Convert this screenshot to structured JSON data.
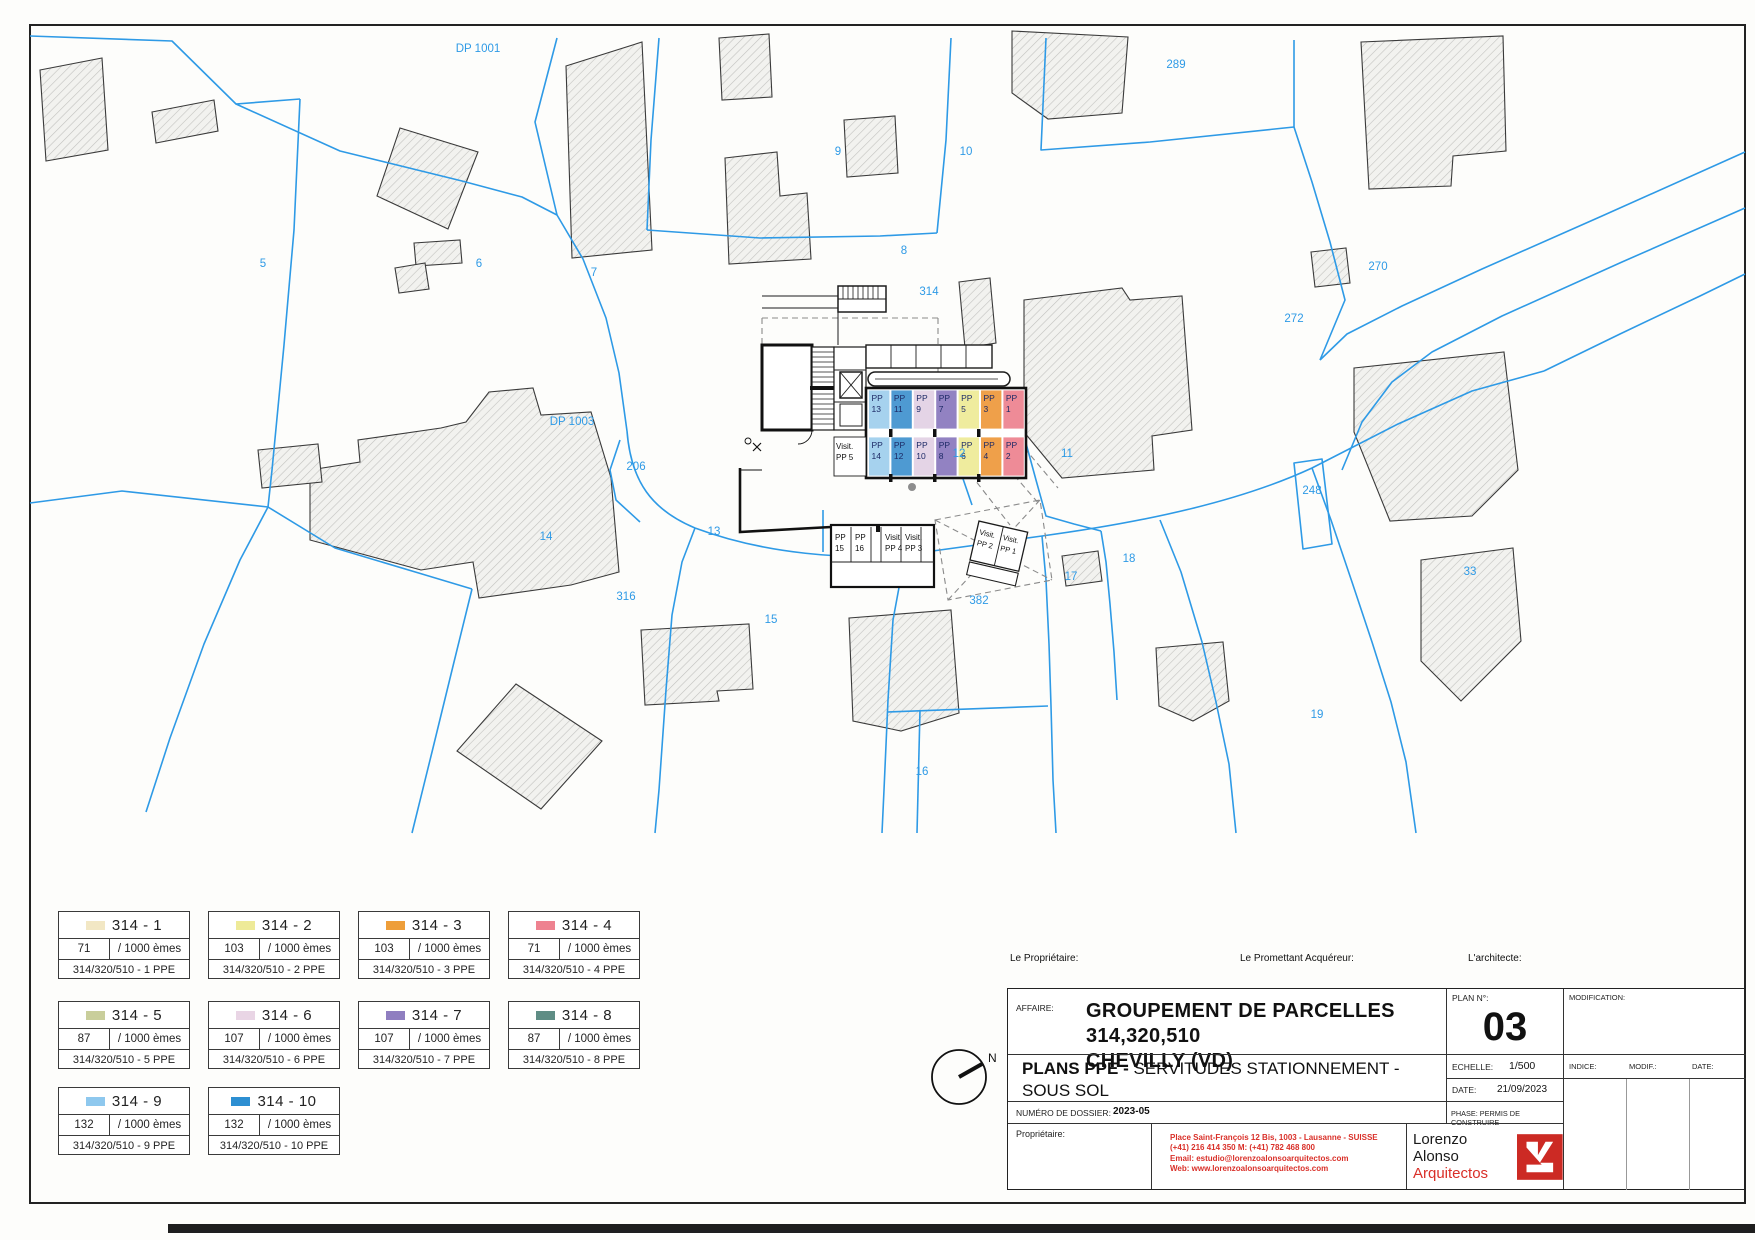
{
  "map": {
    "parcels": [
      {
        "label": "DP 1001",
        "x": 478,
        "y": 52
      },
      {
        "label": "289",
        "x": 1176,
        "y": 68
      },
      {
        "label": "5",
        "x": 263,
        "y": 267
      },
      {
        "label": "6",
        "x": 479,
        "y": 267
      },
      {
        "label": "7",
        "x": 594,
        "y": 276
      },
      {
        "label": "9",
        "x": 838,
        "y": 155
      },
      {
        "label": "10",
        "x": 966,
        "y": 155
      },
      {
        "label": "8",
        "x": 904,
        "y": 254
      },
      {
        "label": "314",
        "x": 929,
        "y": 295
      },
      {
        "label": "270",
        "x": 1378,
        "y": 270
      },
      {
        "label": "272",
        "x": 1294,
        "y": 322
      },
      {
        "label": "DP 1003",
        "x": 572,
        "y": 425
      },
      {
        "label": "206",
        "x": 636,
        "y": 470
      },
      {
        "label": "12",
        "x": 959,
        "y": 457
      },
      {
        "label": "11",
        "x": 1067,
        "y": 457
      },
      {
        "label": "248",
        "x": 1312,
        "y": 494
      },
      {
        "label": "14",
        "x": 546,
        "y": 540
      },
      {
        "label": "13",
        "x": 714,
        "y": 535
      },
      {
        "label": "316",
        "x": 626,
        "y": 600
      },
      {
        "label": "15",
        "x": 771,
        "y": 623
      },
      {
        "label": "382",
        "x": 979,
        "y": 604
      },
      {
        "label": "17",
        "x": 1071,
        "y": 580
      },
      {
        "label": "18",
        "x": 1129,
        "y": 562
      },
      {
        "label": "33",
        "x": 1470,
        "y": 575
      },
      {
        "label": "16",
        "x": 922,
        "y": 775
      },
      {
        "label": "19",
        "x": 1317,
        "y": 718
      }
    ],
    "garage": {
      "visit_left": {
        "l1": "Visit.",
        "l2": "PP 5"
      },
      "rows": [
        {
          "y": 390,
          "stalls": [
            {
              "l1": "PP",
              "l2": "13",
              "color": "#a6d2ee"
            },
            {
              "l1": "PP",
              "l2": "11",
              "color": "#4e9ad2"
            },
            {
              "l1": "PP",
              "l2": "9",
              "color": "#e4d4e6"
            },
            {
              "l1": "PP",
              "l2": "7",
              "color": "#9282c2"
            },
            {
              "l1": "PP",
              "l2": "5",
              "color": "#efec9e"
            },
            {
              "l1": "PP",
              "l2": "3",
              "color": "#efa04a"
            },
            {
              "l1": "PP",
              "l2": "1",
              "color": "#ee8b97"
            }
          ]
        },
        {
          "y": 437,
          "stalls": [
            {
              "l1": "PP",
              "l2": "14",
              "color": "#a6d2ee"
            },
            {
              "l1": "PP",
              "l2": "12",
              "color": "#4e9ad2"
            },
            {
              "l1": "PP",
              "l2": "10",
              "color": "#e4d4e6"
            },
            {
              "l1": "PP",
              "l2": "8",
              "color": "#9282c2"
            },
            {
              "l1": "PP",
              "l2": "6",
              "color": "#efec9e"
            },
            {
              "l1": "PP",
              "l2": "4",
              "color": "#efa04a"
            },
            {
              "l1": "PP",
              "l2": "2",
              "color": "#ee8b97"
            }
          ]
        }
      ],
      "lower_stalls": [
        {
          "l1": "PP",
          "l2": "15"
        },
        {
          "l1": "PP",
          "l2": "16"
        },
        {
          "l1": "Visit.",
          "l2": "PP 4"
        },
        {
          "l1": "Visit.",
          "l2": "PP 3"
        }
      ],
      "angled_stalls": [
        {
          "l1": "Visit.",
          "l2": "PP 2"
        },
        {
          "l1": "Visit.",
          "l2": "PP 1"
        }
      ]
    }
  },
  "legend": {
    "entries": [
      {
        "name": "314 - 1",
        "share": "71",
        "denom": "/ 1000 èmes",
        "ppe": "314/320/510 - 1 PPE",
        "color": "#f2e7c4"
      },
      {
        "name": "314 - 2",
        "share": "103",
        "denom": "/ 1000 èmes",
        "ppe": "314/320/510 - 2 PPE",
        "color": "#eeea98"
      },
      {
        "name": "314 - 3",
        "share": "103",
        "denom": "/ 1000 èmes",
        "ppe": "314/320/510 - 3 PPE",
        "color": "#ee9e3a"
      },
      {
        "name": "314 - 4",
        "share": "71",
        "denom": "/ 1000 èmes",
        "ppe": "314/320/510 - 4 PPE",
        "color": "#ee8290"
      },
      {
        "name": "314 - 5",
        "share": "87",
        "denom": "/ 1000 èmes",
        "ppe": "314/320/510 - 5 PPE",
        "color": "#c9ce9b"
      },
      {
        "name": "314 - 6",
        "share": "107",
        "denom": "/ 1000 èmes",
        "ppe": "314/320/510 - 6 PPE",
        "color": "#e9d5e5"
      },
      {
        "name": "314 - 7",
        "share": "107",
        "denom": "/ 1000 èmes",
        "ppe": "314/320/510 - 7 PPE",
        "color": "#8f7ec0"
      },
      {
        "name": "314 - 8",
        "share": "87",
        "denom": "/ 1000 èmes",
        "ppe": "314/320/510 - 8 PPE",
        "color": "#5f8d85"
      },
      {
        "name": "314 - 9",
        "share": "132",
        "denom": "/ 1000 èmes",
        "ppe": "314/320/510 - 9 PPE",
        "color": "#8ec8ee"
      },
      {
        "name": "314 - 10",
        "share": "132",
        "denom": "/ 1000 èmes",
        "ppe": "314/320/510 - 10 PPE",
        "color": "#2d8fd2"
      }
    ]
  },
  "titleblock": {
    "owner_label": "Le Propriétaire:",
    "buyer_label": "Le Promettant Acquéreur:",
    "architect_label": "L'architecte:",
    "affaire_label": "AFFAIRE:",
    "affaire_line1": "GROUPEMENT DE PARCELLES 314,320,510",
    "affaire_line2": "CHEVILLY (VD)",
    "plan_no_label": "PLAN N°:",
    "plan_no": "03",
    "modification_label": "MODIFICATION:",
    "plans_bold": "PLANS PPE -",
    "plans_rest": " SERVITUDES STATIONNEMENT -",
    "plans_line2": "SOUS SOL",
    "echelle_label": "ECHELLE:",
    "echelle_value": "1/500",
    "indice_label": "INDICE:",
    "modif_label": "MODIF.:",
    "date_col_label": "DATE:",
    "date_label": "DATE:",
    "date_value": "21/09/2023",
    "dossier_label": "NUMÉRO DE DOSSIER:",
    "dossier_value": "2023-05",
    "phase_label": "PHASE:",
    "phase_value": "PERMIS DE CONSTRUIRE",
    "proprietaire_label": "Propriétaire:",
    "address_line1": "Place Saint-François 12 Bis, 1003 - Lausanne - SUISSE",
    "address_line2": "(+41) 216 414 350     M: (+41) 782 468 800",
    "address_line3": "Email: estudio@lorenzoalonsoarquitectos.com",
    "address_line4": "Web: www.lorenzoalonsoarquitectos.com",
    "firm_name1": "Lorenzo Alonso",
    "firm_name2": "Arquitectos",
    "north_label": "N"
  },
  "colors": {
    "parcel_blue": "#2e9ae6",
    "hatch_line": "#c2c2bf",
    "hatch_bg": "#f2f2ef",
    "brand_red": "#d92f28",
    "stall_text": "#1d2a66"
  }
}
